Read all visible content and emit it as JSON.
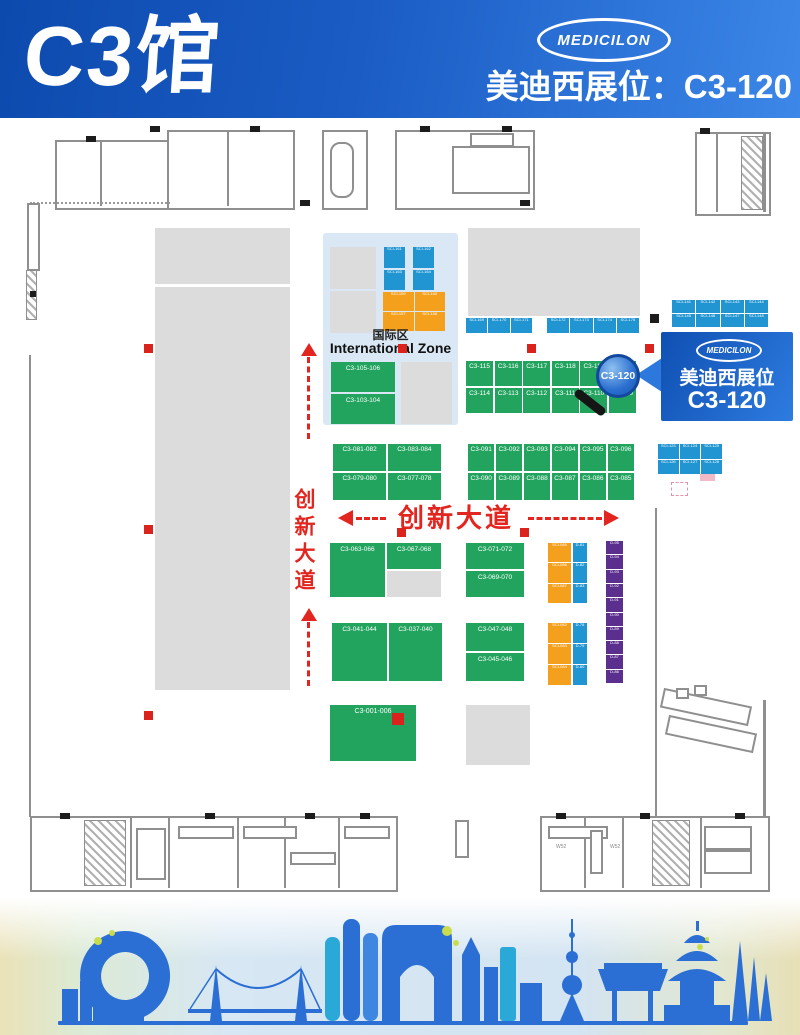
{
  "header": {
    "hall_title": "C3馆",
    "brand": "MEDICILON",
    "subtitle": "美迪西展位：C3-120"
  },
  "callout": {
    "brand": "MEDICILON",
    "line1": "美迪西展位",
    "line2": "C3-120"
  },
  "magnifier": {
    "label": "C3-120"
  },
  "avenue": {
    "label": "创新大道"
  },
  "international_zone": {
    "title_cn": "国际区",
    "title_en": "International Zone",
    "blue_booths": [
      "SCI-161",
      "SCI-162",
      "SCI-163",
      "SCI-164"
    ],
    "orange_booths": [
      "SCI-159",
      "SCI-160",
      "SCI-157",
      "SCI-158"
    ],
    "green_booths": {
      "a": "C3-105-106",
      "b": "C3-103-104"
    }
  },
  "booths": {
    "central_top": [
      "C3-115",
      "C3-116",
      "C3-117",
      "C3-118",
      "C3-119",
      "C3-120"
    ],
    "central_bottom": [
      "C3-114",
      "C3-113",
      "C3-112",
      "C3-111",
      "C3-110",
      "C3-109"
    ],
    "mid_left": [
      "C3-081-082",
      "C3-083-084",
      "C3-079-080",
      "C3-077-078"
    ],
    "mid_right_top": [
      "C3-091",
      "C3-092",
      "C3-093",
      "C3-094",
      "C3-095",
      "C3-096"
    ],
    "mid_right_bottom": [
      "C3-090",
      "C3-089",
      "C3-088",
      "C3-087",
      "C3-086",
      "C3-085"
    ],
    "lower_left_a": "C3-063-066",
    "lower_left_b": "C3-067-068",
    "lower_mid_a": "C3-071-072",
    "lower_mid_b": "C3-069-070",
    "row2_left_a": "C3-041-044",
    "row2_left_b": "C3-037-040",
    "row2_mid_a": "C3-047-048",
    "row2_mid_b": "C3-045-046",
    "bottom_green": "C3-001-006"
  },
  "micro_booths": {
    "strip_left": [
      "SCI-169",
      "SCI-170",
      "SCI-171"
    ],
    "strip_right": [
      "SCI-172",
      "SCI-173",
      "SCI-174",
      "SCI-175"
    ],
    "right_top_grid": [
      "SCI-141",
      "SCI-142",
      "SCI-143",
      "SCI-144",
      "SCI-145",
      "SCI-146",
      "SCI-147",
      "SCI-148"
    ],
    "right_mid_grid": [
      "SCI-123",
      "SCI-124",
      "SCI-125",
      "SCI-126",
      "SCI-127",
      "SCI-128"
    ],
    "orange_col_upper": [
      "SCI-085",
      "SCI-086",
      "SCI-087"
    ],
    "blue_col_upper": [
      "D-81",
      "D-82",
      "D-83"
    ],
    "orange_col_lower": [
      "SCI-082",
      "SCI-083",
      "SCI-084"
    ],
    "blue_col_lower": [
      "D-78",
      "D-79",
      "D-80"
    ],
    "purple_strip": [
      "D-95",
      "D-94",
      "D-93",
      "D-92",
      "D-91",
      "D-90",
      "D-89",
      "D-88",
      "D-87",
      "D-86"
    ]
  },
  "plan_labels": {
    "w1": "W52",
    "w2": "W52"
  },
  "colors": {
    "banner_blue": "#1a5cc4",
    "booth_green": "#22a45f",
    "booth_blue": "#2095d2",
    "booth_orange": "#f5a01d",
    "booth_purple": "#5b2f8e",
    "avenue_red": "#e2251e",
    "marker_red": "#d9231c",
    "intl_panel": "#d9e8f4",
    "skyline_blue": "#2b6fd4"
  }
}
